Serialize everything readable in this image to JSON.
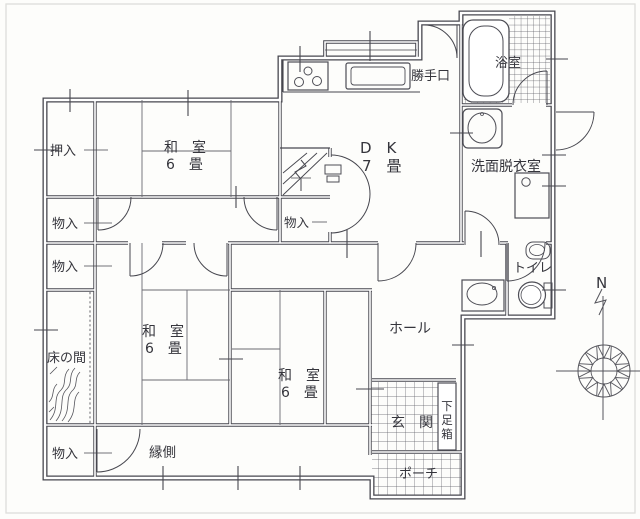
{
  "floorplan": {
    "rooms": {
      "oshiire": {
        "label": "押入"
      },
      "washitsu_nw": {
        "name": "和　室",
        "size": "6　畳"
      },
      "washitsu_w": {
        "name": "和　室",
        "size": "6　畳"
      },
      "washitsu_s": {
        "name": "和　室",
        "size": "6　畳"
      },
      "dk": {
        "name": "D　K",
        "size": "7　畳"
      },
      "katteguchi": {
        "label": "勝手口"
      },
      "yokushitsu": {
        "label": "浴室"
      },
      "senmen_datsuiishitsu": {
        "label": "洗面脱衣室"
      },
      "toire": {
        "label": "トイレ"
      },
      "hall": {
        "label": "ホール"
      },
      "tokonoma": {
        "label": "床の間"
      },
      "engawa": {
        "label": "縁側"
      },
      "genkan": {
        "label": "玄　関"
      },
      "getabako": {
        "label": "下足箱",
        "chars": [
          "下",
          "足",
          "箱"
        ]
      },
      "porch": {
        "label": "ポーチ"
      },
      "monoire_nw": {
        "label": "物入"
      },
      "monoire_w": {
        "label": "物入"
      },
      "monoire_sw": {
        "label": "物入"
      },
      "monoire_stairs": {
        "label": "物入"
      }
    },
    "compass": {
      "north_label": "N"
    },
    "colors": {
      "line": "#47474f",
      "text": "#35353c",
      "tile_line": "#5c5c63",
      "background": "#fdfdfb"
    }
  }
}
